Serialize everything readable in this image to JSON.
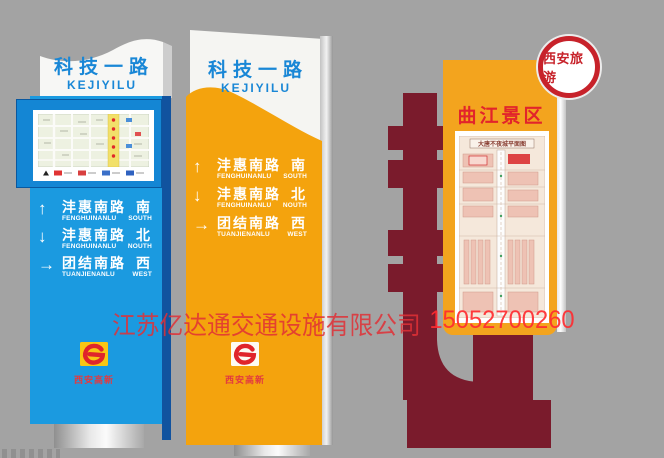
{
  "background_color": "#a3a3a3",
  "watermark": {
    "company": "江苏亿达通交通设施有限公司",
    "phone": "15052700260"
  },
  "route_rows": [
    {
      "arrow": "↑",
      "name_cn": "沣惠南路",
      "dir_cn": "南",
      "name_en": "FENGHUINANLU",
      "dir_en": "SOUTH"
    },
    {
      "arrow": "↓",
      "name_cn": "沣惠南路",
      "dir_cn": "北",
      "name_en": "FENGHUINANLU",
      "dir_en": "NOUTH"
    },
    {
      "arrow": "→",
      "name_cn": "团结南路",
      "dir_cn": "西",
      "name_en": "TUANJIENANLU",
      "dir_en": "WEST"
    }
  ],
  "pillars": {
    "left": {
      "header": {
        "title_cn": "科技一路",
        "title_en": "KEJIYILU"
      },
      "logo_text": "西安高新"
    },
    "middle": {
      "header": {
        "title_cn": "科技一路",
        "title_en": "KEJIYILU"
      },
      "logo_text": "西安高新"
    },
    "right": {
      "badge_text": "西安旅游",
      "title": "曲江景区",
      "map_title": "大唐不夜城平面图"
    }
  },
  "colors": {
    "left_blue": "#1b9ae0",
    "left_side_blue": "#11539f",
    "map_frame_blue": "#1486d4",
    "header_text_blue": "#1987d6",
    "orange": "#f4a30d",
    "maroon": "#7a1b2c",
    "right_panel_orange": "#f3a41e",
    "badge_red": "#c7222a",
    "title_red": "#e2242b",
    "watermark_red": "#e6373c",
    "logo_red": "#e0252b",
    "emblem_yellow": "#f8c614"
  }
}
